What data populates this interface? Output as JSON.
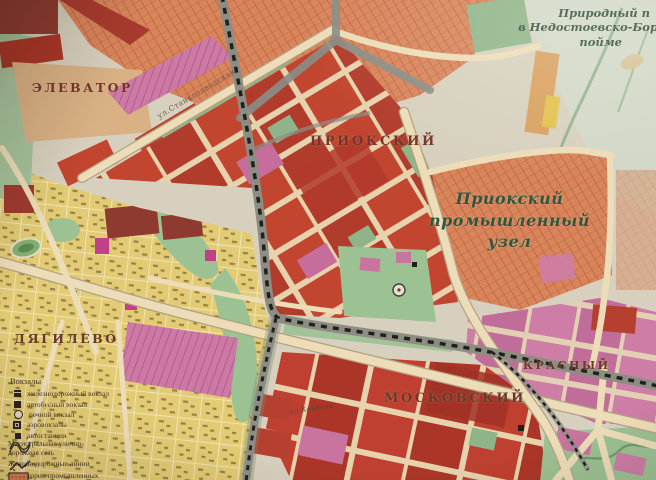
{
  "map": {
    "labels": {
      "elevator": "ЭЛЕВАТОР",
      "prioksky": "ПРИОКСКИЙ",
      "dyagilevo": "ДЯГИЛЕВО",
      "moskovsky": "МОСКОВСКИЙ",
      "krasny": "КРАСНЫЙ",
      "natural_park_lines": [
        "Природный п",
        "в Недостоевско-Бор",
        "пойме"
      ],
      "industrial_node_lines": [
        "Приокский",
        "промышленный",
        "узел"
      ],
      "street_stankozavodskaya": "ул.Станкозаводская",
      "street_konyaeva": "ул.Коняева"
    },
    "colors": {
      "paper": "#d7d0be",
      "industrial": "#d8855c",
      "blocks_red": "#c2462f",
      "blocks_pink": "#cd7da6",
      "private_yellow": "#e2cb74",
      "green": "#9cc193",
      "road": "#ecdcb8",
      "railway": "#22201c",
      "label_green": "#30573b",
      "label_red_brown": "#76352a"
    }
  },
  "legend": {
    "stations_header": "Вокзалы",
    "station_items": [
      {
        "icon": "railway-station",
        "label": "железнодорожный вокзал"
      },
      {
        "icon": "bus-terminal",
        "label": "автобусный вокзал"
      },
      {
        "icon": "river-port",
        "label": "речной вокзал"
      },
      {
        "icon": "airport",
        "label": "аэровокзалы"
      },
      {
        "icon": "bus-stop",
        "label": "автостанция"
      }
    ],
    "road_network_label_line1": "Магистральная улично-",
    "road_network_label_line2": "дорожная сеть",
    "railway_lines_label": "Железнодорожные линии",
    "industrial_territory_label_line1": "Территории промышленных",
    "industrial_territory_label_line2": "узлов"
  }
}
